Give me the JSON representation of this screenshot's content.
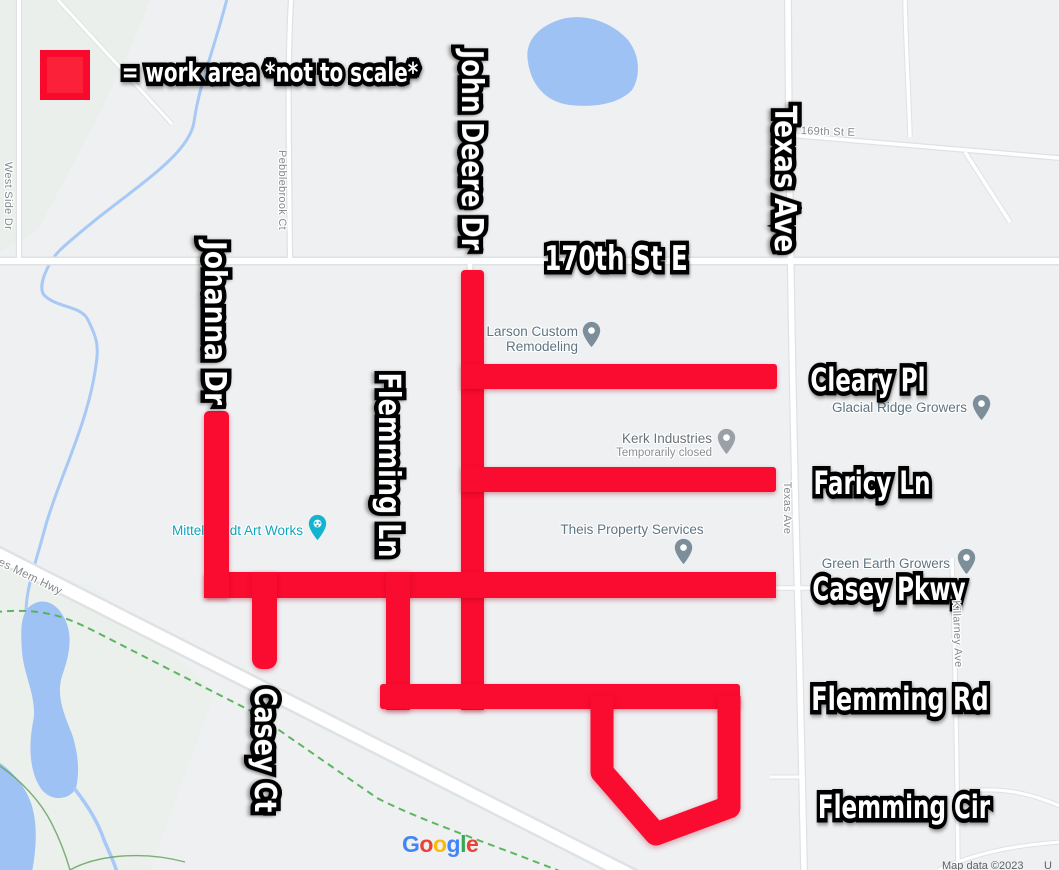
{
  "colors": {
    "work_area_red": "#FA0B30",
    "legend_fill": "#FB2138",
    "legend_border": "#F90A2C",
    "water": "#9FC2F4",
    "road": "#FFFFFF",
    "trail_green": "#4CAF50",
    "poi_label": "#5E7483",
    "poi_pin_blue_gray": "#7B8E99",
    "poi_pin_gray": "#9AA0A6",
    "poi_teal": "#12B4CF",
    "map_background": "#EEF0F2"
  },
  "street_annotations": [
    {
      "id": "legend-text",
      "text": "= work area *not to scale*",
      "cx": 270,
      "cy": 73,
      "rot": 0,
      "fs": 27,
      "sx": 0.74
    },
    {
      "id": "john-deere-dr",
      "text": "John Deere Dr",
      "cx": 471,
      "cy": 150,
      "rot": 90,
      "fs": 30,
      "sx": 0.85
    },
    {
      "id": "texas-ave",
      "text": "Texas Ave",
      "cx": 784,
      "cy": 179,
      "rot": 90,
      "fs": 30,
      "sx": 0.88
    },
    {
      "id": "johanna-dr",
      "text": "Johanna Dr",
      "cx": 214,
      "cy": 323,
      "rot": 90,
      "fs": 30,
      "sx": 0.88
    },
    {
      "id": "flemming-ln",
      "text": "Flemming Ln",
      "cx": 388,
      "cy": 465,
      "rot": 90,
      "fs": 30,
      "sx": 0.85
    },
    {
      "id": "casey-ct",
      "text": "Casey Ct",
      "cx": 264,
      "cy": 750,
      "rot": 90,
      "fs": 30,
      "sx": 0.85
    },
    {
      "id": "170th-st-e",
      "text": "170th St E",
      "cx": 616,
      "cy": 259,
      "rot": 0,
      "fs": 34,
      "sx": 0.72
    },
    {
      "id": "cleary-pl",
      "text": "Cleary Pl",
      "cx": 868,
      "cy": 380,
      "rot": 0,
      "fs": 32,
      "sx": 0.72
    },
    {
      "id": "faricy-ln",
      "text": "Faricy Ln",
      "cx": 872,
      "cy": 483,
      "rot": 0,
      "fs": 32,
      "sx": 0.72
    },
    {
      "id": "casey-pkwy",
      "text": "Casey Pkwy",
      "cx": 889,
      "cy": 589,
      "rot": 0,
      "fs": 32,
      "sx": 0.72
    },
    {
      "id": "flemming-rd",
      "text": "Flemming Rd",
      "cx": 900,
      "cy": 699,
      "rot": 0,
      "fs": 32,
      "sx": 0.75
    },
    {
      "id": "flemming-cir",
      "text": "Flemming Cir",
      "cx": 904,
      "cy": 807,
      "rot": 0,
      "fs": 32,
      "sx": 0.72
    }
  ],
  "road_labels": [
    {
      "id": "west-side-dr",
      "text": "West Side Dr",
      "cx": 8,
      "cy": 196,
      "rot": 90,
      "fs": 11
    },
    {
      "id": "pebblebrook-ct",
      "text": "Pebblebrook Ct",
      "cx": 282,
      "cy": 190,
      "rot": 90,
      "fs": 11
    },
    {
      "id": "169th-st-e",
      "text": "169th St E",
      "cx": 828,
      "cy": 132,
      "rot": 2,
      "fs": 11
    },
    {
      "id": "texas-ave-road",
      "text": "Texas Ave",
      "cx": 787,
      "cy": 508,
      "rot": 90,
      "fs": 11
    },
    {
      "id": "killarney-ave",
      "text": "Killarney Ave",
      "cx": 957,
      "cy": 634,
      "rot": 88,
      "fs": 11
    },
    {
      "id": "es-mem-hwy",
      "text": "es Mem Hwy",
      "cx": 30,
      "cy": 577,
      "rot": 26,
      "fs": 11.5
    }
  ],
  "route_shields": [
    {
      "text": "12",
      "cx": 46,
      "cy": 259
    },
    {
      "text": "12",
      "cx": 741,
      "cy": 262
    },
    {
      "text": "21",
      "cx": 494,
      "cy": 819
    }
  ],
  "pois": [
    {
      "id": "larson",
      "lines": [
        "Larson Custom",
        "Remodeling"
      ],
      "align": "right",
      "tx": 578,
      "ty": 324,
      "color": "#5E7483",
      "pin": {
        "x": 591,
        "y": 334,
        "color": "#7B8E99"
      }
    },
    {
      "id": "kerk",
      "lines": [
        "Kerk Industries"
      ],
      "sub": "Temporarily closed",
      "align": "right",
      "tx": 712,
      "ty": 431,
      "color": "#6A7278",
      "pin": {
        "x": 726,
        "y": 441,
        "color": "#9AA0A6"
      }
    },
    {
      "id": "theis",
      "lines": [
        "Theis Property Services"
      ],
      "align": "center",
      "tx": 632,
      "ty": 522,
      "color": "#5E7483",
      "pin": {
        "x": 683,
        "y": 551,
        "color": "#7B8E99"
      }
    },
    {
      "id": "glacial",
      "lines": [
        "Glacial Ridge Growers"
      ],
      "align": "right",
      "tx": 967,
      "ty": 400,
      "color": "#5E7483",
      "pin": {
        "x": 981,
        "y": 407,
        "color": "#7B8E99"
      }
    },
    {
      "id": "green-earth",
      "lines": [
        "Green Earth Growers"
      ],
      "align": "right",
      "tx": 950,
      "ty": 556,
      "color": "#5E7483",
      "pin": {
        "x": 966,
        "y": 561,
        "color": "#7B8E99"
      }
    },
    {
      "id": "mittelstaedt",
      "lines": [
        "Mittelstaedt Art Works"
      ],
      "align": "right",
      "tx": 303,
      "ty": 523,
      "color": "#0FA6BE",
      "pin": {
        "x": 317,
        "y": 527,
        "color": "#12B4CF",
        "icon": "palette"
      }
    }
  ],
  "work_area": {
    "bars": [
      {
        "id": "john-deere",
        "x": 461,
        "y": 270,
        "w": 23,
        "h": 440,
        "r": "4px 4px 0 0"
      },
      {
        "id": "cleary",
        "x": 461,
        "y": 364,
        "w": 316,
        "h": 25,
        "r": "0 3px 3px 0"
      },
      {
        "id": "faricy",
        "x": 461,
        "y": 467,
        "w": 315,
        "h": 25,
        "r": "0 3px 3px 0"
      },
      {
        "id": "casey-pkwy",
        "x": 204,
        "y": 572,
        "w": 572,
        "h": 26,
        "r": "4px 0 0 4px"
      },
      {
        "id": "johanna",
        "x": 204,
        "y": 411,
        "w": 25,
        "h": 187,
        "r": "5px 5px 0 0"
      },
      {
        "id": "casey-ct",
        "x": 252,
        "y": 572,
        "w": 25,
        "h": 97,
        "r": "0 0 10px 10px"
      },
      {
        "id": "flemming-ln",
        "x": 386,
        "y": 572,
        "w": 24,
        "h": 138,
        "r": "0"
      },
      {
        "id": "flemming-rd",
        "x": 380,
        "y": 684,
        "w": 360,
        "h": 25,
        "r": "3px 3px 3px 3px"
      }
    ],
    "loop": {
      "points": "602,696 602,772 656,834 729,807 729,696",
      "stroke_width": 23
    }
  },
  "footer": {
    "google_letters": [
      {
        "ch": "G",
        "color": "#4285F4"
      },
      {
        "ch": "o",
        "color": "#EA4335"
      },
      {
        "ch": "o",
        "color": "#FBBC05"
      },
      {
        "ch": "g",
        "color": "#4285F4"
      },
      {
        "ch": "l",
        "color": "#34A853"
      },
      {
        "ch": "e",
        "color": "#EA4335"
      }
    ],
    "attribution": "Map data ©2023",
    "attribution_right": "U"
  }
}
